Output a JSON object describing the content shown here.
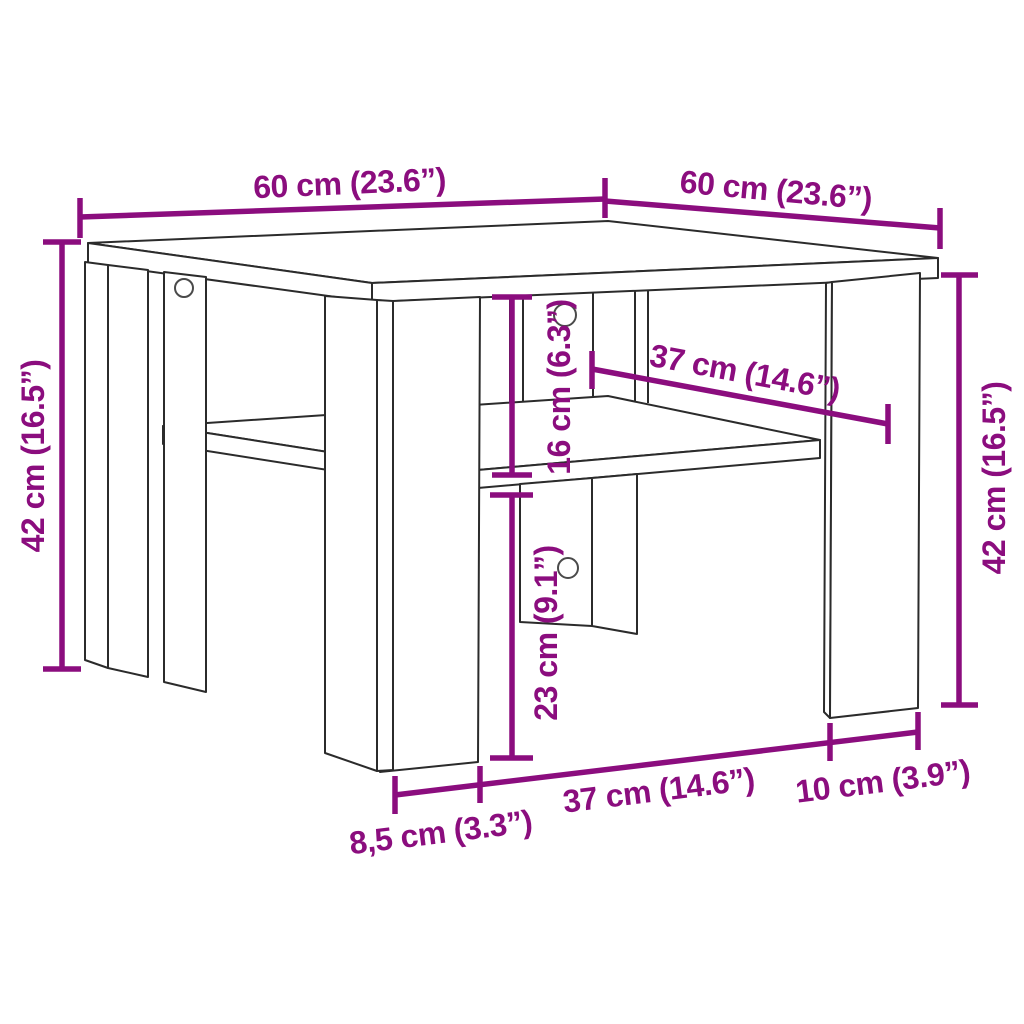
{
  "diagram": {
    "kind": "furniture-dimension-diagram",
    "subject": "square coffee table with lower shelf, corner panel legs and cam-lock holes",
    "accent_color": "#8B0D7E",
    "outline_color": "#2b2b2b",
    "background_color": "#ffffff",
    "labels": {
      "top_width_left": "60 cm (23.6”)",
      "top_width_right": "60 cm (23.6”)",
      "height_left": "42 cm (16.5”)",
      "height_right": "42 cm (16.5”)",
      "shelf_clearance": "16 cm (6.3”)",
      "shelf_span_diagonal": "37 cm (14.6”)",
      "under_shelf_clearance": "23 cm (9.1”)",
      "bottom_leg_depth": "8,5 cm (3.3”)",
      "bottom_span": "37 cm (14.6”)",
      "bottom_leg_width": "10 cm (3.9”)"
    }
  }
}
